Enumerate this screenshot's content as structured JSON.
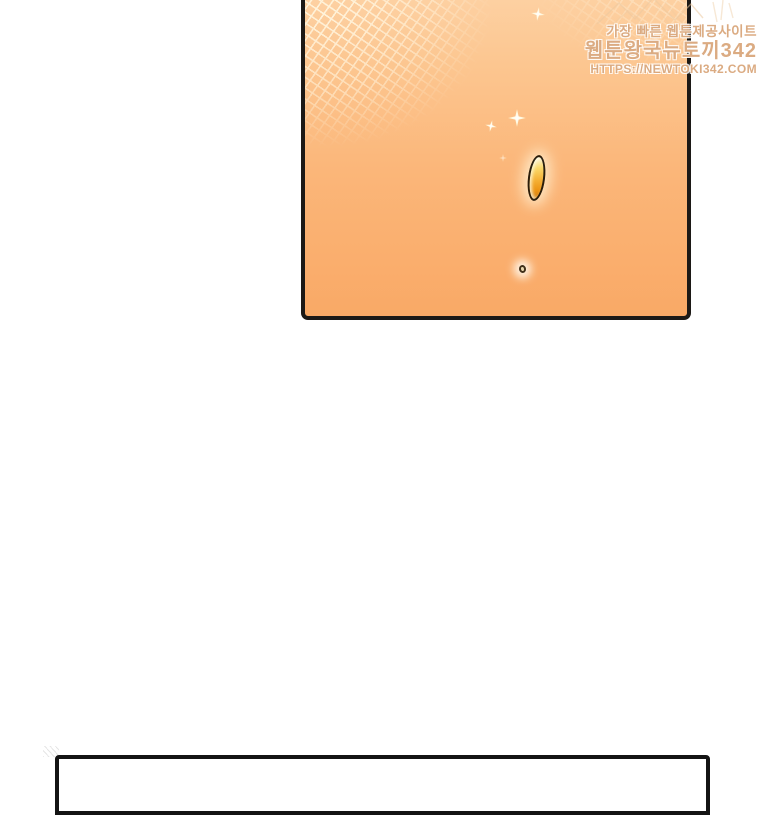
{
  "watermark": {
    "logo": "newtoki-rabbit-sketch-icon",
    "line1": "가장 빠른 웹툰제공사이트",
    "line2": "웹툰왕국뉴토끼342",
    "line3": "HTTPS://NEWTOKI342.COM",
    "text_color": "#d59c6c",
    "outline_color": "#ffffff"
  },
  "comic": {
    "top_panel": {
      "type": "comic-panel",
      "background_gradient_top": "#fdd1a3",
      "background_gradient_bottom": "#f9a966",
      "border_color": "#1c1916",
      "texture": "crosshatch-top-corners",
      "objects": [
        {
          "name": "sparkle-glints",
          "count": 4,
          "color": "#fff7d8"
        },
        {
          "name": "golden-drop",
          "fill_colors": [
            "#fdf3d3",
            "#f5b135",
            "#cf7b0e"
          ],
          "outline_color": "#20160a",
          "glow_color": "#fff3d6"
        },
        {
          "name": "tiny-seed",
          "outline_color": "#413019",
          "fill_color": "#e8d7ae",
          "glow_color": "#fffdf4"
        }
      ]
    },
    "bottom_panel": {
      "type": "comic-panel",
      "background": "#ffffff",
      "border_color": "#141414"
    }
  }
}
